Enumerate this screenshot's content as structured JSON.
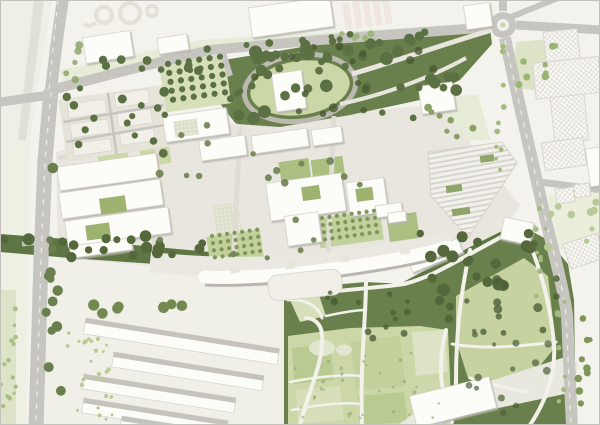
{
  "map": {
    "kind": "architectural-masterplan-site-plan",
    "regions": [
      "north-arterial-road",
      "west-arterial-road",
      "roundabout-north-east",
      "east-arterial-road",
      "north-park-with-oval-lawn",
      "campus-core-buildings",
      "striped-hall-building",
      "cross-shaped-context-building",
      "courtyard-housing-cluster",
      "west-building-complex",
      "arc-shaped-slab-building",
      "south-housing-slabs",
      "south-landscape-park",
      "community-garden-plots",
      "meadow-cells",
      "orchard-grids",
      "tree-belts"
    ]
  },
  "palette": {
    "paper": "#f3f2ed",
    "frame": "#c2c1bc",
    "wash_warm": "#efeee7",
    "wash_rail": "#e0dfd8",
    "green_soft": "#e7ecd8",
    "green_pale": "#dce3c6",
    "green_lawn": "#ccd7a8",
    "green_mid": "#aabf80",
    "green_court": "#9db36f",
    "green_meadow": "#c6d3a0",
    "green_dark": "#69804c",
    "green_belt": "#5f7544",
    "green_chip": "#8fa468",
    "road": "#c6c5c0",
    "road_dash": "#ecebe6",
    "road_minor": "#dedcd4",
    "loop_road": "#bbb9b0",
    "promenade": "#eae8e0",
    "path": "#f2f1ea",
    "path_soft": "#e7e5dc",
    "paving": "#e8e6de",
    "plaza": "#e6e4da",
    "building": "#fcfcf9",
    "building_stroke": "#d5d3cb",
    "building_shadow": "#b8b6ae",
    "beige_base": "#e6e3d8",
    "block": "#f1efe7",
    "pink_row": "#efe6e0",
    "hatch_base": "#faf9f5",
    "hatch_line": "#dbd9d1",
    "stripe_base": "#f1f0ea",
    "stripe_line": "#d2d0c9",
    "slab_band": "#c5c3bc",
    "garden_base": "#dde0cc",
    "garden_dot": "#f6f5ef",
    "cell_a": "#b9cb92",
    "cell_b": "#d6dfba",
    "cell_c": "#c2d09c",
    "cell_d": "#cdd8ac",
    "cell_light": "#e1e7cf",
    "band_light": "#e9e8df",
    "pocket_light": "#d6dfba",
    "loop_outline": "#e2e0d7"
  },
  "map_features": {
    "tree_clusters": [
      {
        "x": 220,
        "y": 36,
        "w": 240,
        "h": 84,
        "count": 46,
        "rmin": 3,
        "rmax": 6.5,
        "color": "#5c7143",
        "opacity": 1,
        "seed": 7
      },
      {
        "x": 240,
        "y": 44,
        "w": 200,
        "h": 70,
        "count": 18,
        "rmin": 2.5,
        "rmax": 4.5,
        "color": "#49582f",
        "opacity": 0.8,
        "seed": 11
      },
      {
        "x": 84,
        "y": 58,
        "w": 120,
        "h": 18,
        "count": 9,
        "rmin": 3,
        "rmax": 4.5,
        "color": "#5c7143",
        "opacity": 1,
        "seed": 21
      },
      {
        "x": 205,
        "y": 42,
        "w": 110,
        "h": 14,
        "count": 8,
        "rmin": 3,
        "rmax": 4.5,
        "color": "#5c7143",
        "opacity": 1,
        "seed": 22
      },
      {
        "x": 318,
        "y": 32,
        "w": 130,
        "h": 12,
        "count": 8,
        "rmin": 2.5,
        "rmax": 4,
        "color": "#5c7143",
        "opacity": 1,
        "seed": 23
      },
      {
        "x": 4,
        "y": 236,
        "w": 200,
        "h": 22,
        "count": 20,
        "rmin": 3.5,
        "rmax": 6,
        "color": "#55683c",
        "opacity": 1,
        "seed": 31
      },
      {
        "x": 400,
        "y": 232,
        "w": 136,
        "h": 58,
        "count": 18,
        "rmin": 3.5,
        "rmax": 6.5,
        "color": "#55683c",
        "opacity": 1,
        "seed": 32
      },
      {
        "x": 286,
        "y": 292,
        "w": 130,
        "h": 48,
        "count": 14,
        "rmin": 2,
        "rmax": 4,
        "color": "#4c5f37",
        "opacity": 0.8,
        "seed": 41
      },
      {
        "x": 430,
        "y": 254,
        "w": 130,
        "h": 80,
        "count": 16,
        "rmin": 2.5,
        "rmax": 5,
        "color": "#4c5f37",
        "opacity": 0.8,
        "seed": 42
      },
      {
        "x": 464,
        "y": 330,
        "w": 104,
        "h": 92,
        "count": 14,
        "rmin": 2,
        "rmax": 4.5,
        "color": "#4c5f37",
        "opacity": 0.7,
        "seed": 43
      },
      {
        "x": 62,
        "y": 88,
        "w": 106,
        "h": 68,
        "count": 16,
        "rmin": 3,
        "rmax": 5,
        "color": "#5c7143",
        "opacity": 1,
        "seed": 51
      },
      {
        "x": 150,
        "y": 120,
        "w": 270,
        "h": 140,
        "count": 20,
        "rmin": 2.5,
        "rmax": 4,
        "color": "#6d8150",
        "opacity": 0.9,
        "seed": 61
      },
      {
        "x": 46,
        "y": 150,
        "w": 18,
        "h": 270,
        "count": 13,
        "rmin": 3.5,
        "rmax": 5.5,
        "color": "#6a7f4e",
        "opacity": 1,
        "seed": 71
      },
      {
        "x": 516,
        "y": 42,
        "w": 40,
        "h": 46,
        "count": 8,
        "rmin": 2.5,
        "rmax": 4,
        "color": "#9ab474",
        "opacity": 1,
        "seed": 81
      },
      {
        "x": 548,
        "y": 198,
        "w": 50,
        "h": 52,
        "count": 9,
        "rmin": 2.5,
        "rmax": 4.5,
        "color": "#b7c996",
        "opacity": 1,
        "seed": 82
      },
      {
        "x": 578,
        "y": 288,
        "w": 14,
        "h": 130,
        "count": 9,
        "rmin": 2.5,
        "rmax": 4,
        "color": "#7f9659",
        "opacity": 1,
        "seed": 83
      },
      {
        "x": 86,
        "y": 298,
        "w": 96,
        "h": 16,
        "count": 7,
        "rmin": 4,
        "rmax": 6,
        "color": "#74894f",
        "opacity": 1,
        "seed": 91
      },
      {
        "x": 493,
        "y": 46,
        "w": 12,
        "h": 140,
        "count": 10,
        "rmin": 1.8,
        "rmax": 3,
        "color": "#a4bb7d",
        "opacity": 1,
        "seed": 92
      },
      {
        "x": 534,
        "y": 200,
        "w": 12,
        "h": 100,
        "count": 8,
        "rmin": 1.8,
        "rmax": 3,
        "color": "#a4bb7d",
        "opacity": 1,
        "seed": 93
      },
      {
        "x": 556,
        "y": 300,
        "w": 12,
        "h": 110,
        "count": 8,
        "rmin": 1.8,
        "rmax": 3,
        "color": "#a4bb7d",
        "opacity": 1,
        "seed": 94
      },
      {
        "x": 60,
        "y": 40,
        "w": 24,
        "h": 40,
        "count": 5,
        "rmin": 2.5,
        "rmax": 4,
        "color": "#8aa064",
        "opacity": 0.8,
        "seed": 96
      },
      {
        "x": 336,
        "y": 28,
        "w": 60,
        "h": 12,
        "count": 5,
        "rmin": 2.5,
        "rmax": 3.5,
        "color": "#9ab474",
        "opacity": 0.9,
        "seed": 97
      },
      {
        "x": 428,
        "y": 100,
        "w": 52,
        "h": 38,
        "count": 7,
        "rmin": 2.5,
        "rmax": 4,
        "color": "#8aa064",
        "opacity": 1,
        "seed": 98
      },
      {
        "x": 64,
        "y": 332,
        "w": 48,
        "h": 88,
        "count": 26,
        "rmin": 1.4,
        "rmax": 2.2,
        "color": "#b9cb92",
        "opacity": 1,
        "seed": 101
      },
      {
        "x": 290,
        "y": 346,
        "w": 150,
        "h": 74,
        "count": 32,
        "rmin": 1.2,
        "rmax": 2,
        "color": "#8aa268",
        "opacity": 0.55,
        "seed": 102
      },
      {
        "x": 0,
        "y": 292,
        "w": 16,
        "h": 130,
        "count": 14,
        "rmin": 1.5,
        "rmax": 2.5,
        "color": "#a9bf85",
        "opacity": 1,
        "seed": 103
      }
    ],
    "orchards": [
      {
        "x": 168,
        "y": 64,
        "cols": 6,
        "rows": 5,
        "dx": 10.5,
        "dy": 9,
        "r": 3.1,
        "angle": -8,
        "color": "#5c7143"
      },
      {
        "x": 322,
        "y": 218,
        "cols": 8,
        "rows": 4,
        "dx": 7.5,
        "dy": 7.2,
        "r": 2.1,
        "angle": -8,
        "color": "#7f9659"
      },
      {
        "x": 212,
        "y": 236,
        "cols": 7,
        "rows": 4,
        "dx": 7.6,
        "dy": 7.2,
        "r": 2.1,
        "angle": -8,
        "color": "#7f9659"
      }
    ]
  }
}
